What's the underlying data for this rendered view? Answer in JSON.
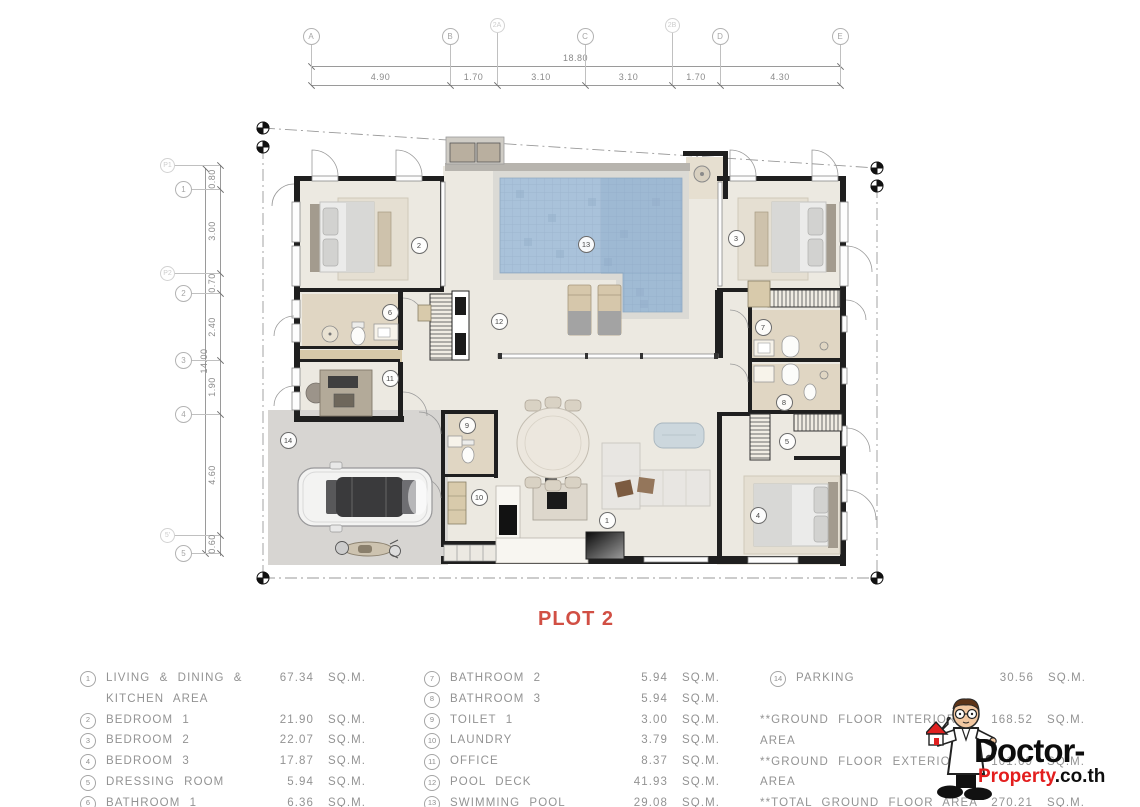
{
  "title": {
    "text": "PLOT 2"
  },
  "units_label": "SQ.M.",
  "legend": {
    "col1": [
      {
        "num": "1",
        "name": "LIVING & DINING &\nKITCHEN AREA",
        "area": "67.34"
      },
      {
        "num": "2",
        "name": "BEDROOM 1",
        "area": "21.90"
      },
      {
        "num": "3",
        "name": "BEDROOM 2",
        "area": "22.07"
      },
      {
        "num": "4",
        "name": "BEDROOM 3",
        "area": "17.87"
      },
      {
        "num": "5",
        "name": "DRESSING ROOM",
        "area": "5.94"
      },
      {
        "num": "6",
        "name": "BATHROOM 1",
        "area": "6.36"
      }
    ],
    "col2": [
      {
        "num": "7",
        "name": "BATHROOM 2",
        "area": "5.94"
      },
      {
        "num": "8",
        "name": "BATHROOM 3",
        "area": "5.94"
      },
      {
        "num": "9",
        "name": "TOILET 1",
        "area": "3.00"
      },
      {
        "num": "10",
        "name": "LAUNDRY",
        "area": "3.79"
      },
      {
        "num": "11",
        "name": "OFFICE",
        "area": "8.37"
      },
      {
        "num": "12",
        "name": "POOL DECK",
        "area": "41.93"
      },
      {
        "num": "13",
        "name": "SWIMMING POOL",
        "area": "29.08"
      }
    ],
    "col3": [
      {
        "num": "14",
        "name": "PARKING",
        "area": "30.56"
      }
    ],
    "totals": [
      {
        "name": "**GROUND FLOOR INTERIOR AREA",
        "area": "168.52"
      },
      {
        "name": "**GROUND FLOOR EXTERIOR AREA",
        "area": "101.69"
      },
      {
        "name": "**TOTAL GROUND FLOOR AREA",
        "area": "270.21"
      },
      {
        "name": "**TOTAL ALL AREA",
        "area": "270.21"
      }
    ]
  },
  "grid_top": {
    "bubbles": [
      {
        "label": "A",
        "x": 311,
        "faint": false
      },
      {
        "label": "B",
        "x": 450,
        "faint": false
      },
      {
        "label": "2A",
        "x": 497,
        "faint": true
      },
      {
        "label": "C",
        "x": 585,
        "faint": false
      },
      {
        "label": "2B",
        "x": 672,
        "faint": true
      },
      {
        "label": "D",
        "x": 720,
        "faint": false
      },
      {
        "label": "E",
        "x": 840,
        "faint": false
      }
    ],
    "total": {
      "label": "18.80",
      "x1": 311,
      "x2": 840
    },
    "segments": [
      {
        "label": "4.90",
        "x1": 311,
        "x2": 450
      },
      {
        "label": "1.70",
        "x1": 450,
        "x2": 497
      },
      {
        "label": "3.10",
        "x1": 497,
        "x2": 585
      },
      {
        "label": "3.10",
        "x1": 585,
        "x2": 672
      },
      {
        "label": "1.70",
        "x1": 672,
        "x2": 720
      },
      {
        "label": "4.30",
        "x1": 720,
        "x2": 840
      }
    ]
  },
  "grid_left": {
    "bubbles": [
      {
        "label": "P1",
        "y": 165,
        "faint": true
      },
      {
        "label": "1",
        "y": 189,
        "faint": false
      },
      {
        "label": "P2",
        "y": 273,
        "faint": true
      },
      {
        "label": "2",
        "y": 293,
        "faint": false
      },
      {
        "label": "3",
        "y": 360,
        "faint": false
      },
      {
        "label": "4",
        "y": 414,
        "faint": false
      },
      {
        "label": "5'",
        "y": 535,
        "faint": true
      },
      {
        "label": "5",
        "y": 553,
        "faint": false
      }
    ],
    "total": {
      "label": "14.00",
      "y1": 168,
      "y2": 553
    },
    "segments": [
      {
        "label": "0.80",
        "y1": 168,
        "y2": 189
      },
      {
        "label": "3.00",
        "y1": 189,
        "y2": 273
      },
      {
        "label": "0.70",
        "y1": 273,
        "y2": 293
      },
      {
        "label": "2.40",
        "y1": 293,
        "y2": 360
      },
      {
        "label": "1.90",
        "y1": 360,
        "y2": 414
      },
      {
        "label": "4.60",
        "y1": 414,
        "y2": 535
      },
      {
        "label": "0.60",
        "y1": 535,
        "y2": 553
      }
    ]
  },
  "plan_markers": [
    {
      "num": "1",
      "x": 606,
      "y": 519
    },
    {
      "num": "2",
      "x": 418,
      "y": 244
    },
    {
      "num": "3",
      "x": 735,
      "y": 237
    },
    {
      "num": "4",
      "x": 757,
      "y": 514
    },
    {
      "num": "5",
      "x": 786,
      "y": 440
    },
    {
      "num": "6",
      "x": 389,
      "y": 311
    },
    {
      "num": "7",
      "x": 762,
      "y": 326
    },
    {
      "num": "8",
      "x": 783,
      "y": 401
    },
    {
      "num": "9",
      "x": 466,
      "y": 424
    },
    {
      "num": "10",
      "x": 478,
      "y": 496
    },
    {
      "num": "11",
      "x": 389,
      "y": 377
    },
    {
      "num": "12",
      "x": 498,
      "y": 320
    },
    {
      "num": "13",
      "x": 585,
      "y": 243
    },
    {
      "num": "14",
      "x": 287,
      "y": 439
    }
  ],
  "watermark": {
    "black1": "Doctor-",
    "red": "Property",
    "black2": ".co.th"
  },
  "colors": {
    "title": "#D14F44",
    "watermark_red": "#E31E1E",
    "pool_water": "#A9C2DA",
    "floor": "#ECE9E1",
    "bath_floor": "#E0D6C3",
    "parking": "#D7D5D2",
    "wall": "#1F1F1F",
    "dim_line": "#9A9A9A",
    "legend_text": "#939393"
  }
}
